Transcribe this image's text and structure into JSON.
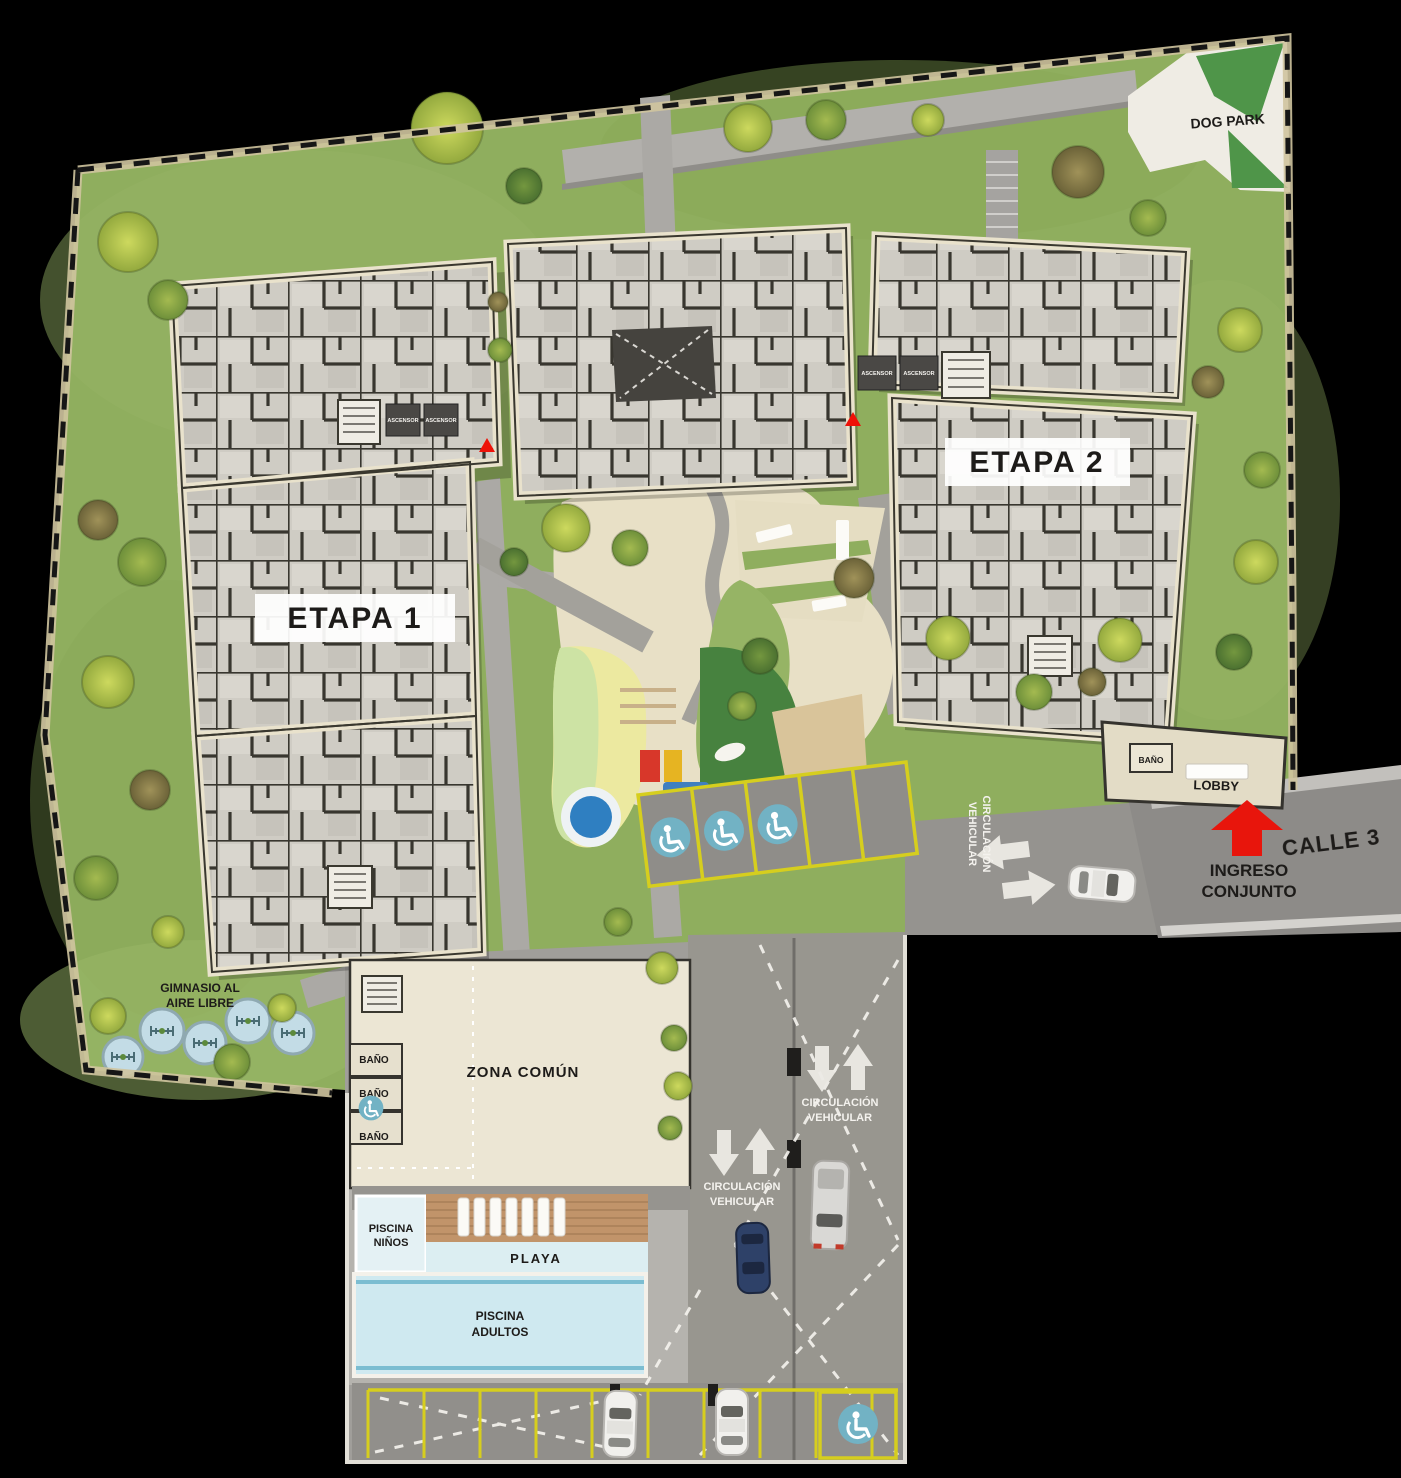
{
  "labels": {
    "dog_park": "DOG PARK",
    "etapa_1": "ETAPA 1",
    "etapa_2": "ETAPA 2",
    "ascensor": "ASCENSOR",
    "gimnasio_line1": "GIMNASIO AL",
    "gimnasio_line2": "AIRE LIBRE",
    "zona_comun": "ZONA COMÚN",
    "bano": "BAÑO",
    "lobby": "LOBBY",
    "ingreso_line1": "INGRESO",
    "ingreso_line2": "CONJUNTO",
    "calle_3": "CALLE 3",
    "circulacion_line1": "CIRCULACIÓN",
    "circulacion_line2": "VEHICULAR",
    "piscina": "PISCINA",
    "ninos": "NIÑOS",
    "adultos": "ADULTOS",
    "playa": "PLAYA"
  },
  "icons": {
    "wheelchair": "accessible parking / accessible bathroom symbol",
    "direction_arrow": "white block arrow (vehicle flow)",
    "entrance_arrow": "red block arrow (complex entrance)",
    "section_marker": "small red triangle marker"
  },
  "counts": {
    "handicap_parking_spots": 4,
    "gym_stations": 5,
    "lounge_chairs": 7,
    "parked_cars": 5,
    "red_section_markers": 2,
    "bathrooms_zona_comun": 3
  },
  "colors": {
    "background": "#000000",
    "grass": "#8fae5e",
    "dogpark_green": "#4f9549",
    "building_fill": "#cfccc4",
    "building_wall": "#38362f",
    "building_rim": "#e9e2cc",
    "road": "#8d8b88",
    "pavement": "#a09e9a",
    "plaza": "#e8e0c6",
    "pool": "#cfe9f0",
    "wood_deck": "#c1946a",
    "parking_line": "#d6ce1e",
    "handicap_blue": "#72b2c4",
    "accent_red": "#e8150c",
    "label_bg": "#ffffff",
    "label_text": "#1d1b19"
  }
}
